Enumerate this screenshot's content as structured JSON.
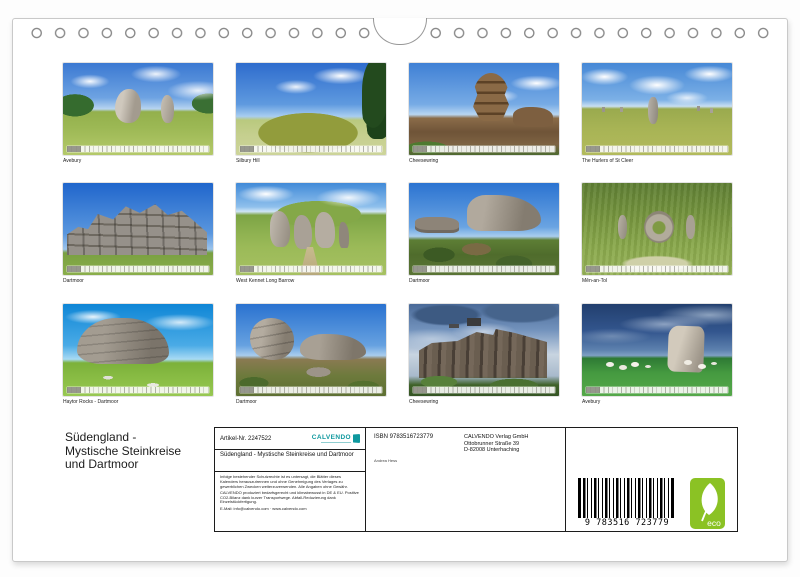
{
  "page": {
    "title_lines": [
      "Südengland -",
      "Mystische Steinkreise",
      "und Dartmoor"
    ]
  },
  "grid": {
    "cells": [
      {
        "caption": "Avebury"
      },
      {
        "caption": "Silbury Hill"
      },
      {
        "caption": "Cheesewring"
      },
      {
        "caption": "The Hurlers of St Cleer"
      },
      {
        "caption": "Dartmoor"
      },
      {
        "caption": "West Kennet Long Barrow"
      },
      {
        "caption": "Dartmoor"
      },
      {
        "caption": "Mên-an-Tol"
      },
      {
        "caption": "Haytor Rocks - Dartmoor"
      },
      {
        "caption": "Dartmoor"
      },
      {
        "caption": "Cheesewring"
      },
      {
        "caption": "Avebury"
      }
    ]
  },
  "info": {
    "article_label": "Artikel-Nr. 2247522",
    "logo_text": "CALVENDO",
    "title": "Südengland - Mystische Steinkreise und Dartmoor",
    "legal": "Infolge bestehender Schutzrechte ist es untersagt, die Blätter dieses Kalenders herauszutrennen und ohne Genehmigung des Verlages zu gewerblichen Zwecken weiterzuverwenden. Alle Angaben ohne Gewähr.",
    "eco_note": "CALVENDO produziert bedarfsgerecht und klimabewusst in DE & EU. Positive CO2-Bilanz dank kurzer Transportwege. Abfall-Reduzierung dank Einzelstückfertigung.",
    "email_line": "E-Mail: info@calvendo.com · www.calvendo.com",
    "isbn": "ISBN 9783516723779",
    "author": "Andrea Hess",
    "publisher_lines": [
      "CALVENDO Verlag GmbH",
      "Ottobrunner Straße 39",
      "D-82008 Unterhaching"
    ],
    "barcode_digits": "9 783516 723779",
    "eco_label": "eco",
    "colors": {
      "calvendo_teal": "#0e989e",
      "eco_green": "#8bc224"
    }
  }
}
